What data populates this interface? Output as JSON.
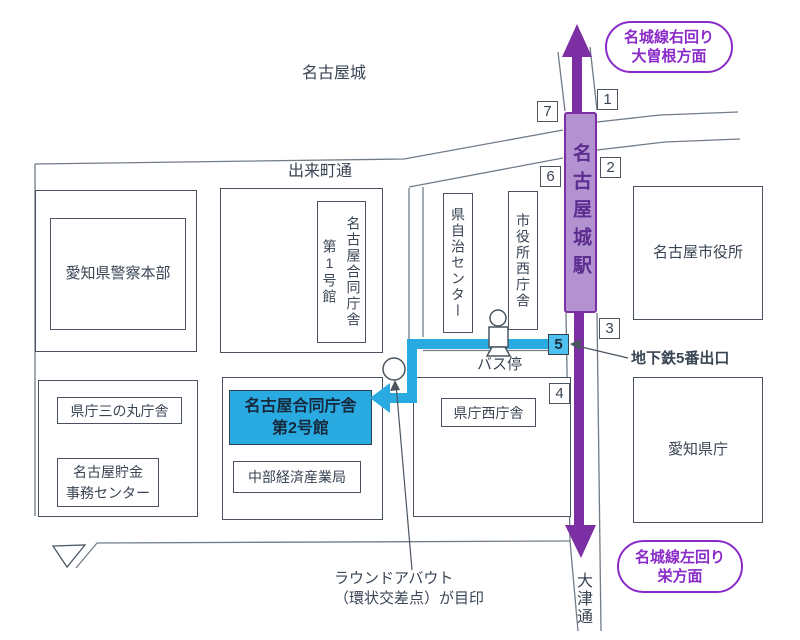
{
  "map": {
    "area_labels": {
      "nagoya_castle": "名古屋城",
      "dekimachi_street": "出来町通",
      "otsu_street": "大津通"
    },
    "station": {
      "name": "名古屋城駅"
    },
    "metro": {
      "up_direction": {
        "line1": "名城線右回り",
        "line2": "大曽根方面"
      },
      "down_direction": {
        "line1": "名城線左回り",
        "line2": "栄方面"
      }
    },
    "exits": {
      "e1": "1",
      "e2": "2",
      "e3": "3",
      "e4": "4",
      "e5": "5",
      "e6": "6",
      "e7": "7"
    },
    "buildings": {
      "police_hq": "愛知県警察本部",
      "gov_bldg_1": "名古屋合同庁舎\n第1号館",
      "jichi_center": "県自治センター",
      "city_hall_west": "市役所西庁舎",
      "city_hall": "名古屋市役所",
      "sannomaru": "県庁三の丸庁舎",
      "savings_center": "名古屋貯金\n事務センター",
      "gov_bldg_2": "名古屋合同庁舎\n第2号館",
      "chubu_meti": "中部経済産業局",
      "kencho_west": "県庁西庁舎",
      "aichi_kencho": "愛知県庁"
    },
    "annotations": {
      "subway_exit": "地下鉄5番出口",
      "bus_stop": "バス停",
      "roundabout": "ラウンドアバウト\n（環状交差点）が目印"
    },
    "colors": {
      "metro_purple": "#7b2fa2",
      "station_fill": "#b392d2",
      "station_text": "#5b2d8e",
      "bubble_purple": "#8a2bc8",
      "route_blue": "#29abe2",
      "exit5_fill": "#4ec1f0",
      "road_gray": "#717c87",
      "ink": "#3a4554"
    }
  }
}
